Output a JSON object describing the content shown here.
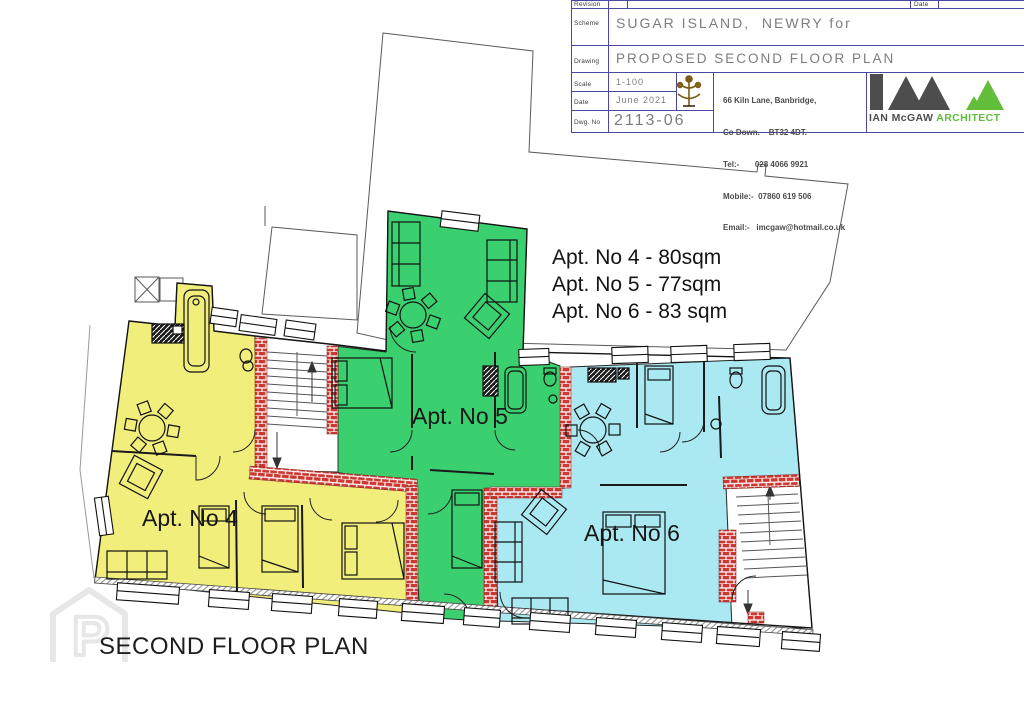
{
  "title_block": {
    "revision_label": "Revision",
    "revision_date_label": "Date",
    "scheme_label": "Scheme",
    "scheme_value": "SUGAR ISLAND,  NEWRY for",
    "drawing_label": "Drawing",
    "drawing_value": "PROPOSED SECOND FLOOR PLAN",
    "scale_label": "Scale",
    "scale_value": "1-100",
    "date_label": "Date",
    "date_value": "June 2021",
    "dwg_label": "Dwg. No",
    "dwg_value": "2113-06",
    "contact": {
      "line1": "66 Kiln Lane, Banbridge,",
      "line2": "Co Down.    BT32 4DT.",
      "line3": "Tel:-       028 4066 9921",
      "line4": "Mobile:-  07860 619 506",
      "line5": "Email:-   imcgaw@hotmail.co.uk"
    },
    "logo": {
      "name": "IAN McGAW",
      "title": "ARCHITECT"
    }
  },
  "plan": {
    "title": "SECOND FLOOR PLAN",
    "annotations": [
      "Apt. No 4 - 80sqm",
      "Apt. No 5 - 77sqm",
      "Apt. No 6 - 83 sqm"
    ],
    "apartments": [
      {
        "id": "apt-4",
        "label": "Apt. No 4",
        "area": "80sqm",
        "color": "#f2ee7b"
      },
      {
        "id": "apt-5",
        "label": "Apt. No 5",
        "area": "77sqm",
        "color": "#3bd06f"
      },
      {
        "id": "apt-6",
        "label": "Apt. No 6",
        "area": "83 sqm",
        "color": "#abe9f2"
      }
    ],
    "watermark_letter": "P"
  },
  "colors": {
    "wall_brick_red": "#cd3932",
    "table_line_blue": "#4a47a3",
    "value_text_gray": "#7d7d7d",
    "logo_green": "#62bd3a",
    "logo_gray": "#4d4d4d"
  }
}
